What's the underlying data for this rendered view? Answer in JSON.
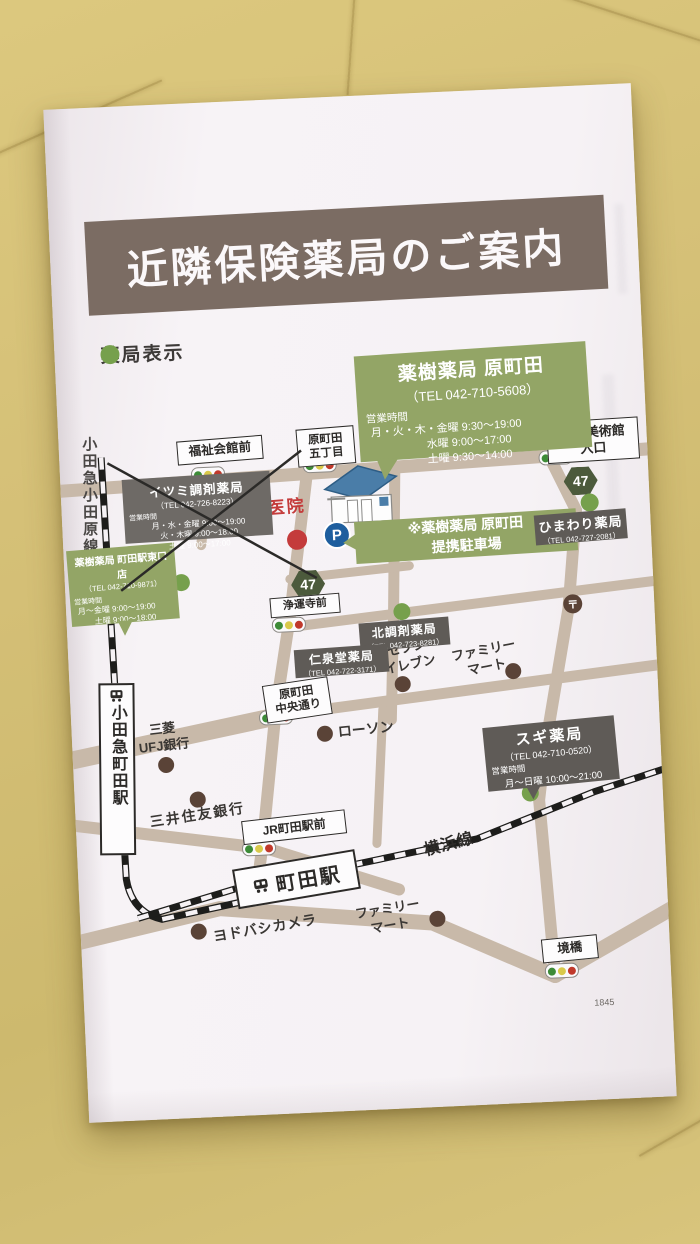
{
  "title": "近隣保険薬局のご案内",
  "legend_label": "薬局表示",
  "page_number": "1845",
  "colors": {
    "banner_brown": "#7b6c63",
    "pharmacy_green": "#93a566",
    "closed_gray_box": "#6e6a66",
    "dark_gray_box": "#5f5b57",
    "road_tan": "#c8b9a9",
    "dot_brown": "#5a4337",
    "dot_green": "#76a04c",
    "clinic_red": "#c43b3b",
    "parking_blue": "#1e5e9e",
    "leather_background": "#d5c077"
  },
  "boxes": {
    "main": {
      "name": "薬樹薬局 原町田",
      "tel": "（TEL 042-710-5608）",
      "hours_heading": "営業時間",
      "hours": "月・火・木・金曜 9:30～19:00\n　　　　　水曜 9:00～17:00\n　　　　　土曜 9:30～14:00"
    },
    "higashiguchi": {
      "name": "薬樹薬局 町田駅東口店",
      "tel": "（TEL 042-710-9871）",
      "hours_heading": "営業時間",
      "hours": "月～金曜 9:00～19:00\n　　土曜 9:00～18:00"
    },
    "itsumi": {
      "name": "イツミ調剤薬局",
      "tel": "（TEL 042-726-8223）",
      "hours_heading": "営業時間",
      "hours": "月・水・金曜 9:00～19:00\n火・木曜 9:00～18:00\n土曜 9:00～17:00",
      "status": "closed-crossed-out"
    },
    "himawari": {
      "name": "ひまわり薬局",
      "tel": "（TEL 042-727-2081）"
    },
    "kita": {
      "name": "北調剤薬局",
      "tel": "（TEL 042-723-8281）"
    },
    "jinsendo": {
      "name": "仁泉堂薬局",
      "tel": "（TEL 042-722-3171）"
    },
    "sugi": {
      "name": "スギ薬局",
      "tel": "（TEL 042-710-0520）",
      "hours_heading": "営業時間",
      "hours": "月～日曜 10:00～21:00"
    }
  },
  "parking": {
    "p": "P",
    "note": "※薬樹薬局 原町田\n提携駐車場"
  },
  "clinic": {
    "name": "黒江医院"
  },
  "route_shield": "47",
  "postal_mark": "〒",
  "signs": {
    "fukushi": "福祉会館前",
    "haramachida5": "原町田\n五丁目",
    "hanga": "版画美術館\n入口",
    "joounji": "浄運寺前",
    "chuo": "原町田\n中央通り",
    "jr_mae": "JR町田駅前",
    "sakaibashi": "境橋"
  },
  "stations": {
    "odakyu_odawara_line": "小田急小田原線",
    "odakyu_machida": "小田急町田駅",
    "machida": "町田駅",
    "yokohama_line": "横浜線"
  },
  "landmarks": {
    "seven": "セブン\nイレブン",
    "familymart_n": "ファミリー\nマート",
    "lawson": "ローソン",
    "mitsubishi": "三菱\nUFJ銀行",
    "smbc": "三井住友銀行",
    "yodobashi": "ヨドバシカメラ",
    "familymart_s": "ファミリー\nマート"
  }
}
